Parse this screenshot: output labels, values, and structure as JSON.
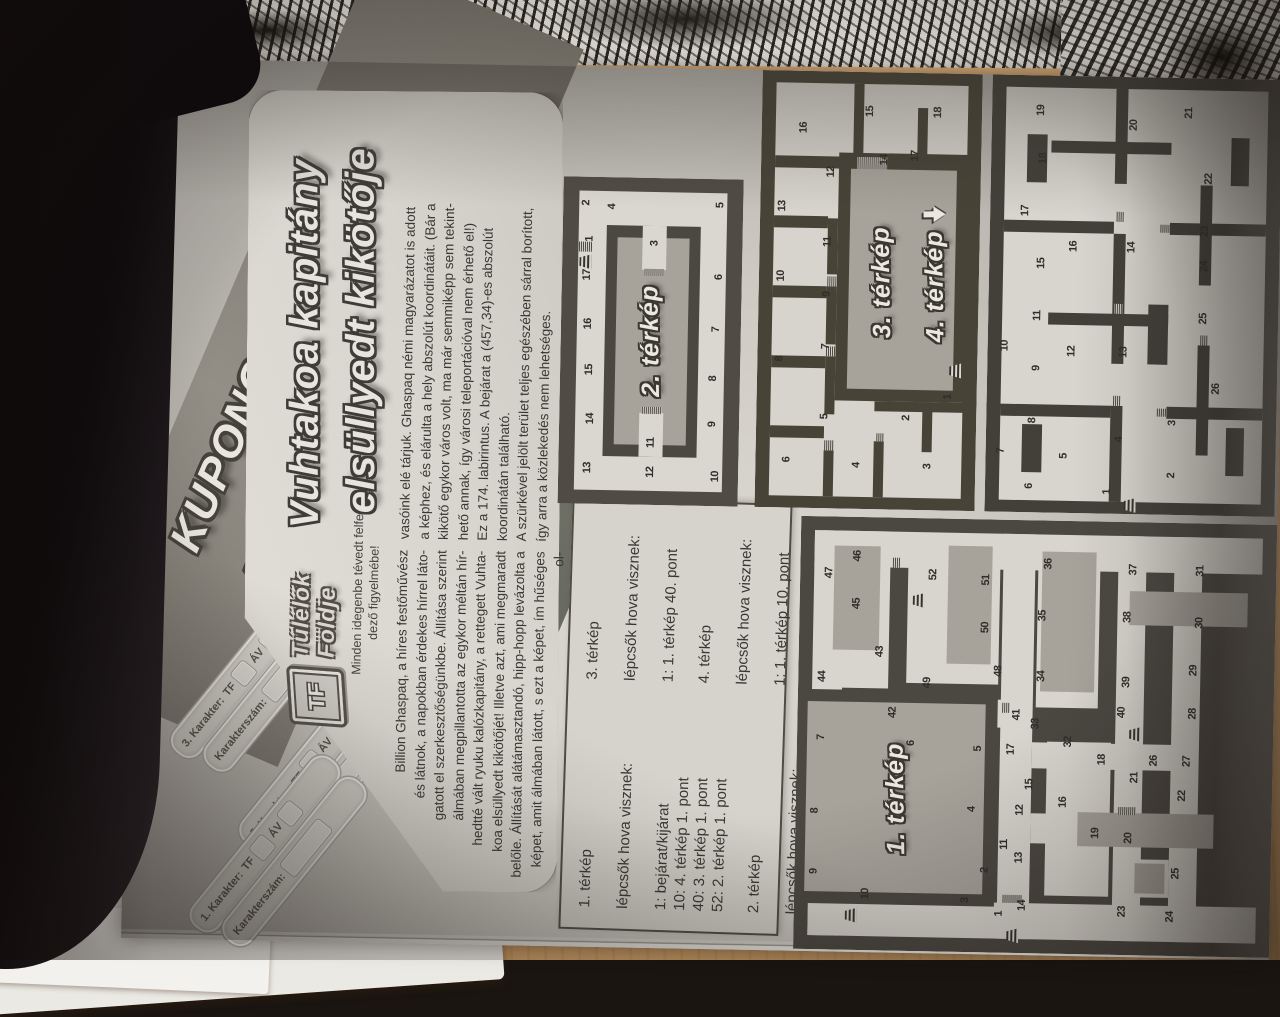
{
  "photo": {
    "handwritten_mark": "5.",
    "colors": {
      "desk_wood": "#e2b586",
      "dark_object": "#0e0a0c",
      "paper_sheet": "#ebe9e4",
      "page_paper": "#d8d5ce",
      "maze_wall": "#4b4741",
      "mud_gray": "#a7a39b"
    }
  },
  "page": {
    "header": {
      "line1": "KUPONOK AZ",
      "line2": "ALANORI KRÓNIKÁBAN"
    },
    "coupons": [
      {
        "number_label": "3. Karakter:",
        "tf_label": "TF",
        "av_label": "ÁV",
        "serial_label": "Karakterszám:"
      },
      {
        "number_label": "2. Karakter:",
        "tf_label": "TF",
        "av_label": "ÁV",
        "serial_label": "Karakterszám:"
      },
      {
        "number_label": "1. Karakter:",
        "tf_label": "TF",
        "av_label": "ÁV",
        "serial_label": "Karakterszám:"
      }
    ],
    "masthead": {
      "logo_monogram": "TF",
      "logo_name_lines": [
        "Túlélők",
        "Földje"
      ],
      "tagline_lines": [
        "Minden idegenbe tévedt felfe-",
        "dező figyelmébe!"
      ],
      "title_line1": "Vuhtakoa kapitány",
      "title_line2": "elsüllyedt kikötője"
    },
    "article": {
      "col1_lines": [
        "Billion Ghaspaq, a híres festőművész",
        "és látnok, a napokban érdekes hírrel láto-",
        "gatott el szerkesztőségünkbe. Állítása szerint",
        "álmában megpillantotta az egykor méltán hír-",
        "hedtté vált ryuku kalózkapitány, a rettegett Vuhta-",
        "koa elsüllyedt kikötőjét! Illetve azt, ami megmaradt",
        "belőle. Állítását alátámasztandó, hipp-hopp levázolta a",
        "képet, amit álmában látott, s ezt a képet, ím hűséges ol-"
      ],
      "col2_lines": [
        "vasóink elé tárjuk. Ghaspaq némi magyarázatot is adott",
        "a képhez, és elárulta a hely abszolút koordinátáit. (Bár a",
        "kikötő egykor város volt, ma már semmiképp sem tekint-",
        "hető annak, így városi teleportációval nem érhető el!)",
        "Ez a 174. labirintus. A bejárat a (457,34)-es abszolút",
        "koordinátán található.",
        "A szürkével jelölt terület teljes egészében sárral borított,",
        "így arra a közlekedés nem lehetséges."
      ]
    },
    "legend": {
      "groups": [
        {
          "title": "1. térkép",
          "subtitle": "lépcsők hova visznek:",
          "entries": [
            "1: bejárat/kijárat",
            "10: 4. térkép 1. pont",
            "40: 3. térkép 1. pont",
            "52: 2. térkép 1. pont"
          ]
        },
        {
          "title": "2. térkép",
          "subtitle": "lépcsők hova visznek:",
          "entries": [
            "1: 1. térkép 52. pont"
          ]
        },
        {
          "title": "3. térkép",
          "subtitle": "lépcsők hova visznek:",
          "entries": [
            "1: 1. térkép 40. pont"
          ]
        },
        {
          "title": "4. térkép",
          "subtitle": "lépcsők hova visznek:",
          "entries": [
            "1: 1. térkép 10. pont"
          ]
        }
      ]
    },
    "maps": [
      {
        "id": "map1",
        "label": "1. térkép",
        "points": [
          {
            "n": 1,
            "x": 9,
            "y": 43,
            "stairs": true,
            "sx": 4,
            "sy": 46
          },
          {
            "n": 2,
            "x": 19,
            "y": 40
          },
          {
            "n": 3,
            "x": 12,
            "y": 36
          },
          {
            "n": 4,
            "x": 33,
            "y": 37
          },
          {
            "n": 5,
            "x": 47,
            "y": 38
          },
          {
            "n": 6,
            "x": 48,
            "y": 24
          },
          {
            "n": 7,
            "x": 49,
            "y": 5
          },
          {
            "n": 8,
            "x": 32,
            "y": 4
          },
          {
            "n": 9,
            "x": 18,
            "y": 4
          },
          {
            "n": 10,
            "x": 13,
            "y": 15,
            "stairs": true,
            "sx": 8,
            "sy": 12
          },
          {
            "n": 11,
            "x": 25,
            "y": 44
          },
          {
            "n": 12,
            "x": 33,
            "y": 47
          },
          {
            "n": 13,
            "x": 22,
            "y": 47
          },
          {
            "n": 14,
            "x": 11,
            "y": 48
          },
          {
            "n": 15,
            "x": 39,
            "y": 49
          },
          {
            "n": 16,
            "x": 35,
            "y": 56
          },
          {
            "n": 17,
            "x": 47,
            "y": 45
          },
          {
            "n": 18,
            "x": 45,
            "y": 64
          },
          {
            "n": 19,
            "x": 28,
            "y": 63
          },
          {
            "n": 20,
            "x": 27,
            "y": 70
          },
          {
            "n": 21,
            "x": 41,
            "y": 71
          },
          {
            "n": 22,
            "x": 37,
            "y": 81
          },
          {
            "n": 23,
            "x": 10,
            "y": 69
          },
          {
            "n": 24,
            "x": 9,
            "y": 79
          },
          {
            "n": 25,
            "x": 19,
            "y": 80
          },
          {
            "n": 26,
            "x": 45,
            "y": 75
          },
          {
            "n": 27,
            "x": 45,
            "y": 82
          },
          {
            "n": 28,
            "x": 56,
            "y": 83
          },
          {
            "n": 29,
            "x": 66,
            "y": 83
          },
          {
            "n": 30,
            "x": 77,
            "y": 84
          },
          {
            "n": 31,
            "x": 89,
            "y": 84
          },
          {
            "n": 32,
            "x": 49,
            "y": 57
          },
          {
            "n": 33,
            "x": 53,
            "y": 50
          },
          {
            "n": 34,
            "x": 64,
            "y": 51
          },
          {
            "n": 35,
            "x": 78,
            "y": 51
          },
          {
            "n": 36,
            "x": 90,
            "y": 52
          },
          {
            "n": 37,
            "x": 89,
            "y": 70
          },
          {
            "n": 38,
            "x": 78,
            "y": 69
          },
          {
            "n": 39,
            "x": 63,
            "y": 69
          },
          {
            "n": 40,
            "x": 56,
            "y": 68,
            "stairs": true,
            "sx": 51,
            "sy": 71
          },
          {
            "n": 41,
            "x": 55,
            "y": 46
          },
          {
            "n": 42,
            "x": 55,
            "y": 20
          },
          {
            "n": 43,
            "x": 69,
            "y": 17
          },
          {
            "n": 44,
            "x": 63,
            "y": 5
          },
          {
            "n": 45,
            "x": 80,
            "y": 12
          },
          {
            "n": 46,
            "x": 91,
            "y": 12
          },
          {
            "n": 47,
            "x": 87,
            "y": 6
          },
          {
            "n": 48,
            "x": 65,
            "y": 42
          },
          {
            "n": 49,
            "x": 62,
            "y": 27
          },
          {
            "n": 50,
            "x": 75,
            "y": 39
          },
          {
            "n": 51,
            "x": 86,
            "y": 39
          },
          {
            "n": 52,
            "x": 87,
            "y": 28,
            "stairs": true,
            "sx": 81,
            "sy": 25
          }
        ]
      },
      {
        "id": "map2",
        "label": "2. térkép",
        "points": [
          {
            "n": 1,
            "x": 81,
            "y": 15,
            "stairs": true,
            "sx": 74,
            "sy": 13
          },
          {
            "n": 2,
            "x": 92,
            "y": 13
          },
          {
            "n": 3,
            "x": 80,
            "y": 51
          },
          {
            "n": 4,
            "x": 91,
            "y": 27
          },
          {
            "n": 5,
            "x": 92,
            "y": 87
          },
          {
            "n": 6,
            "x": 70,
            "y": 87
          },
          {
            "n": 7,
            "x": 54,
            "y": 86
          },
          {
            "n": 8,
            "x": 39,
            "y": 85
          },
          {
            "n": 9,
            "x": 25,
            "y": 85
          },
          {
            "n": 10,
            "x": 9,
            "y": 87
          },
          {
            "n": 11,
            "x": 19,
            "y": 51
          },
          {
            "n": 12,
            "x": 10,
            "y": 51
          },
          {
            "n": 13,
            "x": 11,
            "y": 16
          },
          {
            "n": 14,
            "x": 26,
            "y": 17
          },
          {
            "n": 15,
            "x": 41,
            "y": 16
          },
          {
            "n": 16,
            "x": 55,
            "y": 15
          },
          {
            "n": 17,
            "x": 70,
            "y": 14
          }
        ]
      },
      {
        "id": "map3",
        "label": "3. térkép",
        "label2": "4. térkép",
        "points": [
          {
            "n": 1,
            "x": 26,
            "y": 87,
            "stairs": true,
            "sx": 32,
            "sy": 90
          },
          {
            "n": 2,
            "x": 21,
            "y": 68
          },
          {
            "n": 3,
            "x": 10,
            "y": 78
          },
          {
            "n": 4,
            "x": 10,
            "y": 46
          },
          {
            "n": 5,
            "x": 21,
            "y": 31
          },
          {
            "n": 6,
            "x": 11,
            "y": 14
          },
          {
            "n": 7,
            "x": 37,
            "y": 31
          },
          {
            "n": 8,
            "x": 34,
            "y": 10
          },
          {
            "n": 9,
            "x": 49,
            "y": 31
          },
          {
            "n": 10,
            "x": 53,
            "y": 10
          },
          {
            "n": 11,
            "x": 61,
            "y": 31
          },
          {
            "n": 12,
            "x": 77,
            "y": 32
          },
          {
            "n": 13,
            "x": 69,
            "y": 10
          },
          {
            "n": 14,
            "x": 80,
            "y": 56
          },
          {
            "n": 15,
            "x": 91,
            "y": 49
          },
          {
            "n": 16,
            "x": 87,
            "y": 19
          },
          {
            "n": 17,
            "x": 81,
            "y": 70
          },
          {
            "n": 18,
            "x": 91,
            "y": 80
          }
        ]
      },
      {
        "id": "map4",
        "label": "4. térkép",
        "points": [
          {
            "n": 1,
            "x": 5,
            "y": 42,
            "stairs": true,
            "sx": 2,
            "sy": 50
          },
          {
            "n": 2,
            "x": 9,
            "y": 64
          },
          {
            "n": 3,
            "x": 21,
            "y": 64
          },
          {
            "n": 4,
            "x": 17,
            "y": 46
          },
          {
            "n": 5,
            "x": 13,
            "y": 27
          },
          {
            "n": 6,
            "x": 6,
            "y": 15
          },
          {
            "n": 7,
            "x": 14,
            "y": 5
          },
          {
            "n": 8,
            "x": 21,
            "y": 16
          },
          {
            "n": 9,
            "x": 33,
            "y": 17
          },
          {
            "n": 10,
            "x": 38,
            "y": 6
          },
          {
            "n": 11,
            "x": 45,
            "y": 17
          },
          {
            "n": 12,
            "x": 37,
            "y": 29
          },
          {
            "n": 13,
            "x": 37,
            "y": 47
          },
          {
            "n": 14,
            "x": 61,
            "y": 49
          },
          {
            "n": 15,
            "x": 57,
            "y": 18
          },
          {
            "n": 16,
            "x": 61,
            "y": 29
          },
          {
            "n": 17,
            "x": 69,
            "y": 12
          },
          {
            "n": 18,
            "x": 81,
            "y": 18
          },
          {
            "n": 19,
            "x": 92,
            "y": 17
          },
          {
            "n": 20,
            "x": 89,
            "y": 49
          },
          {
            "n": 21,
            "x": 92,
            "y": 68
          },
          {
            "n": 22,
            "x": 77,
            "y": 75
          },
          {
            "n": 23,
            "x": 65,
            "y": 74
          },
          {
            "n": 24,
            "x": 57,
            "y": 74
          },
          {
            "n": 25,
            "x": 45,
            "y": 74
          },
          {
            "n": 26,
            "x": 29,
            "y": 79
          }
        ]
      }
    ]
  }
}
